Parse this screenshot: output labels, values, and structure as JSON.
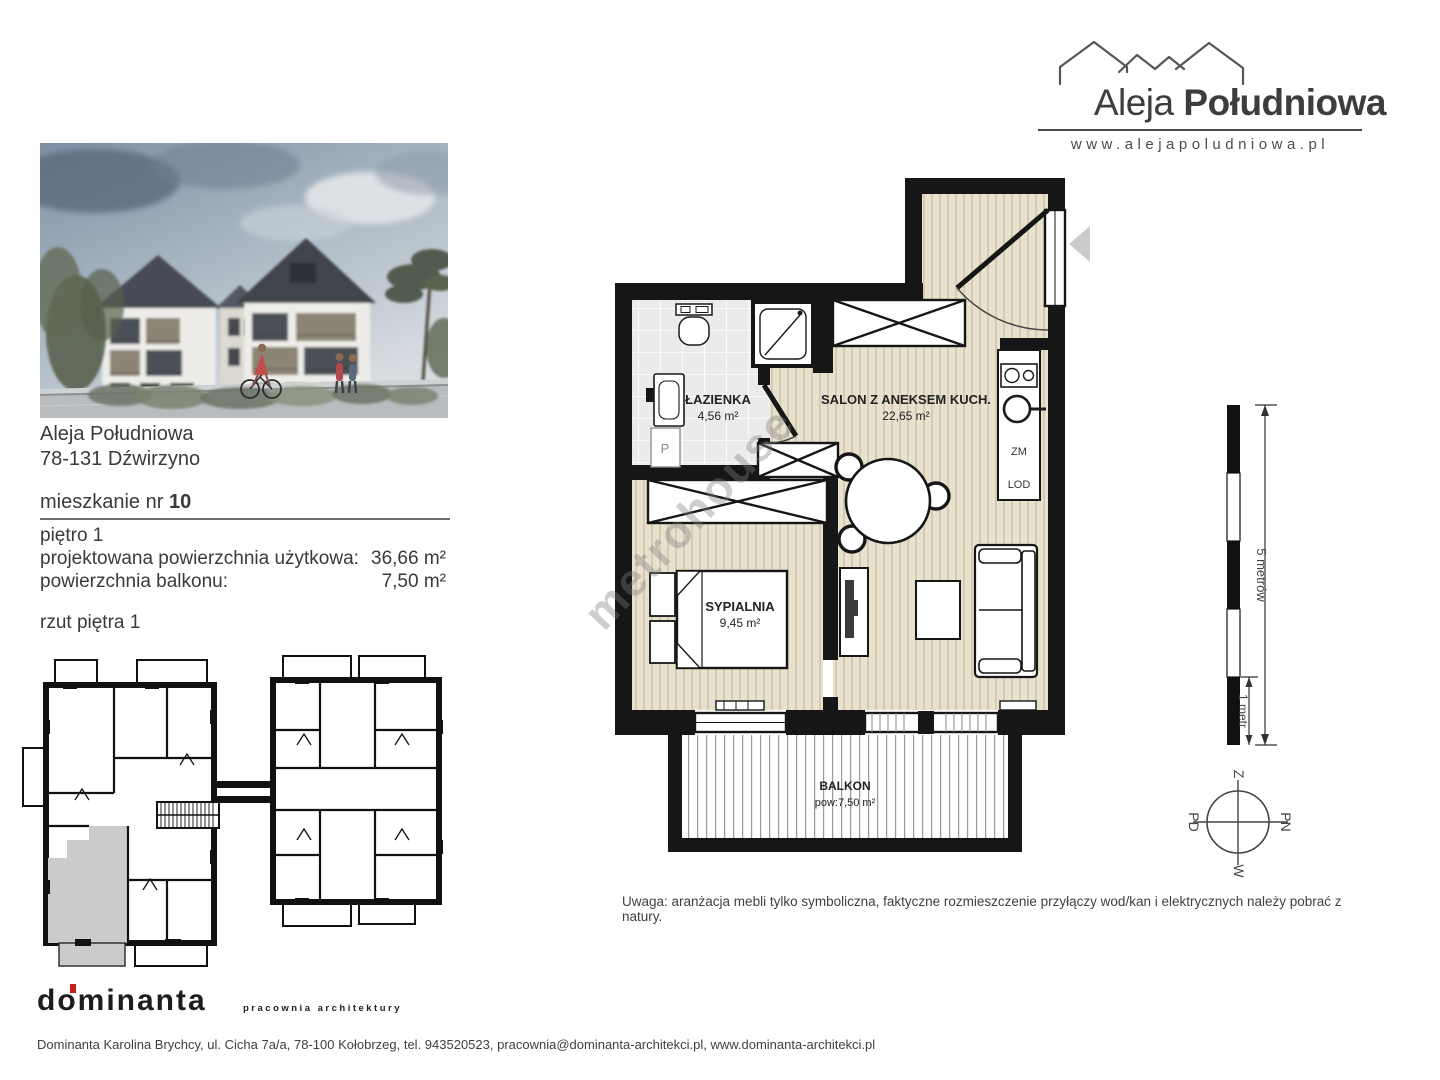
{
  "header": {
    "brand_name_regular": "Aleja",
    "brand_name_bold": "Południowa",
    "website": "www.alejapoludniowa.pl"
  },
  "listing": {
    "development_name": "Aleja Południowa",
    "address": "78-131 Dźwirzyno",
    "unit_label": "mieszkanie nr",
    "unit_number": "10",
    "floor_label": "piętro 1",
    "rows": [
      {
        "label": "projektowana powierzchnia użytkowa:",
        "value": "36,66 m²"
      },
      {
        "label": "powierzchnia balkonu:",
        "value": "7,50 m²"
      }
    ],
    "plan_caption": "rzut piętra 1"
  },
  "apartment_plan": {
    "rooms": [
      {
        "name": "ŁAZIENKA",
        "area": "4,56 m²"
      },
      {
        "name": "SALON Z ANEKSEM KUCH.",
        "area": "22,65 m²"
      },
      {
        "name": "SYPIALNIA",
        "area": "9,45 m²"
      },
      {
        "name": "BALKON",
        "area": "pow:7,50 m²"
      }
    ],
    "annotations": {
      "pantry": "P",
      "dishwasher": "ZM",
      "fridge": "LOD"
    }
  },
  "scale_bar": {
    "full_label": "5 metrów",
    "unit_label": "1 metr"
  },
  "compass": {
    "top": "Z",
    "right": "PN",
    "bottom": "W",
    "left": "PD"
  },
  "note": "Uwaga: aranżacja mebli tylko symboliczna, faktyczne rozmieszczenie przyłączy wod/kan i elektrycznych należy pobrać z natury.",
  "watermark": "metrohouse",
  "footer": {
    "studio_logo": "dominanta",
    "studio_tagline": "pracownia architektury",
    "contact_line": "Dominanta Karolina Brychcy, ul. Cicha 7a/a, 78-100 Kołobrzeg, tel. 943520523, pracownia@dominanta-architekci.pl, www.dominanta-architekci.pl"
  },
  "colors": {
    "floor": "#e8e1cd",
    "floor_stripe": "#d3cbb3",
    "tile": "#ebebeb",
    "wall": "#161616",
    "highlight_gray": "#cbcbcb",
    "accent_red": "#c41e1e"
  }
}
